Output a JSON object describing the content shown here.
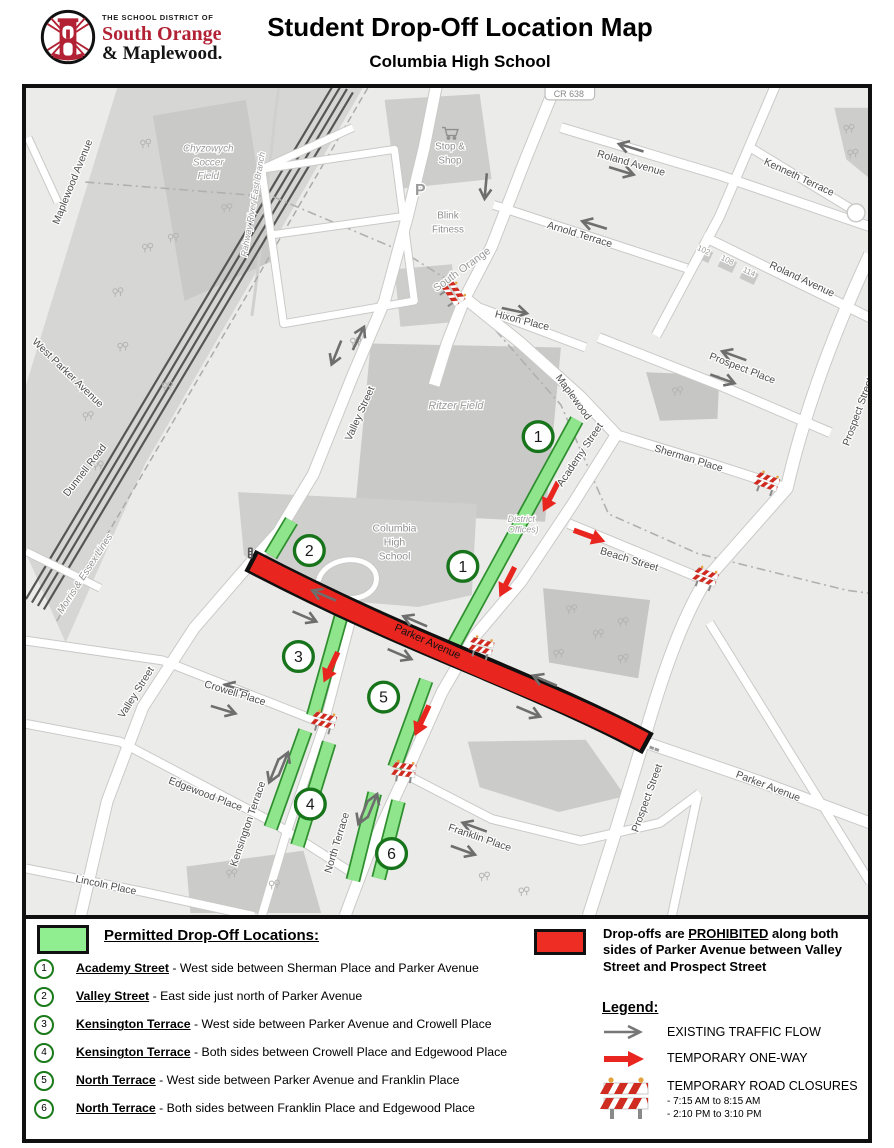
{
  "header": {
    "district": {
      "line1": "THE SCHOOL DISTRICT OF",
      "line2": "South Orange",
      "line3": "& Maplewood."
    },
    "title": "Student Drop-Off Location Map",
    "subtitle": "Columbia High School"
  },
  "colors": {
    "permitted_green": "#90EE90",
    "strip_green": "#8fe58c",
    "strip_border": "#2f8f2f",
    "badge_ring": "#17741a",
    "prohibited_red": "#E8251E",
    "arrow_gray": "#6e6e6e",
    "brand_red": "#b22234"
  },
  "map": {
    "labels": [
      {
        "t": "Maplewood Avenue",
        "x": 50,
        "y": 96,
        "r": -68,
        "s": 10.5
      },
      {
        "t": "West Parker Avenue",
        "x": 40,
        "y": 290,
        "r": 44,
        "s": 10.5
      },
      {
        "t": "Dunnell Road",
        "x": 62,
        "y": 388,
        "r": -52,
        "s": 10.5
      },
      {
        "t": "Morris & Essex Lines",
        "x": 62,
        "y": 492,
        "r": -57,
        "s": 10,
        "c": "#8f8f8f",
        "i": 1
      },
      {
        "t": "Valley Street",
        "x": 340,
        "y": 330,
        "r": -66,
        "s": 10.5
      },
      {
        "t": "Valley Street",
        "x": 114,
        "y": 612,
        "r": -58,
        "s": 10.5
      },
      {
        "t": "Rahway River East Branch",
        "x": 232,
        "y": 118,
        "r": -80,
        "s": 9,
        "c": "#9a9a9a",
        "i": 1
      },
      {
        "t": "South Orange",
        "x": 442,
        "y": 186,
        "r": -36,
        "s": 11,
        "c": "#999999"
      },
      {
        "t": "Hixon Place",
        "x": 500,
        "y": 238,
        "r": 14,
        "s": 10.5
      },
      {
        "t": "Maplewood",
        "x": 550,
        "y": 314,
        "r": 54,
        "s": 10.5
      },
      {
        "t": "Academy Street",
        "x": 562,
        "y": 372,
        "r": -56,
        "s": 10.5
      },
      {
        "t": "Sherman Place",
        "x": 668,
        "y": 377,
        "r": 17,
        "s": 10.5
      },
      {
        "t": "Beach Street",
        "x": 608,
        "y": 479,
        "r": 17,
        "s": 10.5
      },
      {
        "t": "Arnold Terrace",
        "x": 558,
        "y": 151,
        "r": 17,
        "s": 10.5
      },
      {
        "t": "Roland Avenue",
        "x": 610,
        "y": 79,
        "r": 16,
        "s": 10.5
      },
      {
        "t": "Roland Avenue",
        "x": 782,
        "y": 196,
        "r": 25,
        "s": 10.5
      },
      {
        "t": "Kenneth Terrace",
        "x": 779,
        "y": 93,
        "r": 25,
        "s": 10.5
      },
      {
        "t": "Prospect Place",
        "x": 722,
        "y": 286,
        "r": 21,
        "s": 10.5
      },
      {
        "t": "Prospect Street",
        "x": 843,
        "y": 328,
        "r": -70,
        "s": 10.5
      },
      {
        "t": "Prospect Street",
        "x": 630,
        "y": 718,
        "r": -70,
        "s": 10.5
      },
      {
        "t": "Parker Avenue",
        "x": 404,
        "y": 562,
        "r": 24,
        "s": 11,
        "c": "#111111",
        "h": 0
      },
      {
        "t": "Parker Avenue",
        "x": 748,
        "y": 708,
        "r": 21,
        "s": 10.5
      },
      {
        "t": "Crowell Place",
        "x": 210,
        "y": 614,
        "r": 17,
        "s": 10.5
      },
      {
        "t": "Edgewood Place",
        "x": 180,
        "y": 716,
        "r": 21,
        "s": 10.5
      },
      {
        "t": "Lincoln Place",
        "x": 80,
        "y": 808,
        "r": 12,
        "s": 10.5
      },
      {
        "t": "Kensington Terrace",
        "x": 227,
        "y": 744,
        "r": -71,
        "s": 10.5
      },
      {
        "t": "North Terrace",
        "x": 317,
        "y": 763,
        "r": -73,
        "s": 10.5
      },
      {
        "t": "Franklin Place",
        "x": 457,
        "y": 760,
        "r": 19,
        "s": 10.5
      },
      {
        "t": "Ritzer Field",
        "x": 434,
        "y": 324,
        "r": 0,
        "s": 11,
        "c": "#9a9a9a",
        "i": 1
      },
      {
        "t": "Chyzowych",
        "x": 184,
        "y": 64,
        "r": 0,
        "s": 10,
        "c": "#9a9a9a",
        "i": 1
      },
      {
        "t": "Soccer",
        "x": 184,
        "y": 78,
        "r": 0,
        "s": 10,
        "c": "#9a9a9a",
        "i": 1
      },
      {
        "t": "Field",
        "x": 184,
        "y": 92,
        "r": 0,
        "s": 10,
        "c": "#9a9a9a",
        "i": 1
      },
      {
        "t": "Columbia",
        "x": 372,
        "y": 448,
        "r": 0,
        "s": 10.5,
        "c": "#8f8f8f"
      },
      {
        "t": "High",
        "x": 372,
        "y": 462,
        "r": 0,
        "s": 10.5,
        "c": "#8f8f8f"
      },
      {
        "t": "School",
        "x": 372,
        "y": 476,
        "r": 0,
        "s": 10.5,
        "c": "#8f8f8f"
      },
      {
        "t": "District",
        "x": 500,
        "y": 438,
        "r": 0,
        "s": 9,
        "c": "#a0a0a0",
        "i": 1
      },
      {
        "t": "Offices)",
        "x": 502,
        "y": 449,
        "r": 0,
        "s": 9,
        "c": "#a0a0a0",
        "i": 1
      },
      {
        "t": "Stop &",
        "x": 428,
        "y": 62,
        "r": 0,
        "s": 10,
        "c": "#8f8f8f"
      },
      {
        "t": "Shop",
        "x": 428,
        "y": 76,
        "r": 0,
        "s": 10,
        "c": "#8f8f8f"
      },
      {
        "t": "Blink",
        "x": 426,
        "y": 132,
        "r": 0,
        "s": 10,
        "c": "#8f8f8f"
      },
      {
        "t": "Fitness",
        "x": 426,
        "y": 146,
        "r": 0,
        "s": 10,
        "c": "#8f8f8f"
      },
      {
        "t": "P",
        "x": 398,
        "y": 108,
        "r": 0,
        "s": 16,
        "c": "#9a9a9a",
        "b": 1
      },
      {
        "t": "102",
        "x": 683,
        "y": 166,
        "r": 25,
        "s": 8,
        "c": "#9a9a9a"
      },
      {
        "t": "108",
        "x": 707,
        "y": 176,
        "r": 25,
        "s": 8,
        "c": "#9a9a9a"
      },
      {
        "t": "114",
        "x": 729,
        "y": 188,
        "r": 25,
        "s": 8,
        "c": "#9a9a9a"
      },
      {
        "t": "CR 638",
        "x": 548,
        "y": 9,
        "r": 0,
        "s": 9,
        "c": "#888888"
      }
    ],
    "badges": [
      {
        "n": "1",
        "x": 517,
        "y": 352
      },
      {
        "n": "1",
        "x": 441,
        "y": 483
      },
      {
        "n": "2",
        "x": 286,
        "y": 467
      },
      {
        "n": "3",
        "x": 275,
        "y": 574
      },
      {
        "n": "5",
        "x": 361,
        "y": 615
      },
      {
        "n": "4",
        "x": 287,
        "y": 723
      },
      {
        "n": "6",
        "x": 369,
        "y": 773
      }
    ],
    "green_strips": [
      [
        556,
        335,
        430,
        566
      ],
      [
        404,
        598,
        372,
        686
      ],
      [
        268,
        437,
        247,
        472
      ],
      [
        318,
        534,
        290,
        634
      ],
      [
        282,
        649,
        247,
        747
      ],
      [
        306,
        661,
        274,
        765
      ],
      [
        352,
        712,
        330,
        800
      ],
      [
        376,
        720,
        356,
        798
      ]
    ],
    "gray_arrows": [
      [
        313,
        268,
        112
      ],
      [
        336,
        252,
        -64
      ],
      [
        464,
        100,
        95
      ],
      [
        494,
        225,
        12
      ],
      [
        573,
        138,
        197
      ],
      [
        610,
        60,
        197
      ],
      [
        602,
        84,
        17
      ],
      [
        714,
        270,
        200
      ],
      [
        704,
        294,
        20
      ],
      [
        300,
        512,
        203
      ],
      [
        282,
        534,
        23
      ],
      [
        392,
        538,
        203
      ],
      [
        378,
        572,
        23
      ],
      [
        523,
        598,
        203
      ],
      [
        508,
        630,
        23
      ],
      [
        212,
        606,
        197
      ],
      [
        200,
        628,
        17
      ],
      [
        250,
        690,
        112
      ],
      [
        260,
        682,
        -68
      ],
      [
        340,
        732,
        112
      ],
      [
        350,
        724,
        -68
      ],
      [
        452,
        746,
        200
      ],
      [
        442,
        770,
        20
      ]
    ],
    "red_arrows": [
      [
        530,
        412,
        117
      ],
      [
        486,
        498,
        117
      ],
      [
        308,
        584,
        115
      ],
      [
        400,
        638,
        115
      ],
      [
        568,
        452,
        20
      ]
    ],
    "barriers": [
      [
        430,
        209,
        55
      ],
      [
        748,
        400,
        20
      ],
      [
        686,
        496,
        20
      ],
      [
        460,
        566,
        15
      ],
      [
        301,
        641,
        15
      ],
      [
        382,
        691,
        8
      ]
    ],
    "trees": [
      [
        118,
        55
      ],
      [
        146,
        150
      ],
      [
        90,
        205
      ],
      [
        60,
        330
      ],
      [
        330,
        255
      ],
      [
        160,
        60
      ],
      [
        200,
        120
      ],
      [
        120,
        160
      ],
      [
        95,
        260
      ],
      [
        140,
        300
      ],
      [
        548,
        525
      ],
      [
        575,
        550
      ],
      [
        600,
        538
      ],
      [
        535,
        570
      ],
      [
        600,
        575
      ],
      [
        205,
        792
      ],
      [
        248,
        803
      ],
      [
        828,
        40
      ],
      [
        832,
        65
      ],
      [
        460,
        795
      ],
      [
        500,
        810
      ],
      [
        655,
        305
      ],
      [
        70,
        380
      ]
    ]
  },
  "panel": {
    "permitted": {
      "heading": "Permitted Drop-Off Locations:",
      "items": [
        {
          "num": "1",
          "street": "Academy Street",
          "desc": "- West side between Sherman Place and Parker Avenue"
        },
        {
          "num": "2",
          "street": "Valley Street",
          "desc": "- East side just north of Parker Avenue"
        },
        {
          "num": "3",
          "street": "Kensington Terrace",
          "desc": "- West side between Parker Avenue and Crowell Place"
        },
        {
          "num": "4",
          "street": "Kensington Terrace",
          "desc": "- Both sides between Crowell Place and Edgewood Place"
        },
        {
          "num": "5",
          "street": "North Terrace",
          "desc": "- West side between Parker Avenue and Franklin Place"
        },
        {
          "num": "6",
          "street": "North Terrace",
          "desc": "- Both sides between Franklin Place and Edgewood Place"
        }
      ]
    },
    "prohibited": {
      "before": "Drop-offs are ",
      "underlined": "PROHIBITED",
      "after": " along both sides of Parker Avenue between Valley Street and Prospect Street"
    },
    "legend": {
      "heading": "Legend:",
      "items": [
        {
          "label": "EXISTING TRAFFIC FLOW"
        },
        {
          "label": "TEMPORARY ONE-WAY"
        },
        {
          "label": "TEMPORARY ROAD CLOSURES",
          "sub1": "- 7:15 AM to 8:15 AM",
          "sub2": "- 2:10 PM to 3:10 PM"
        }
      ]
    }
  }
}
